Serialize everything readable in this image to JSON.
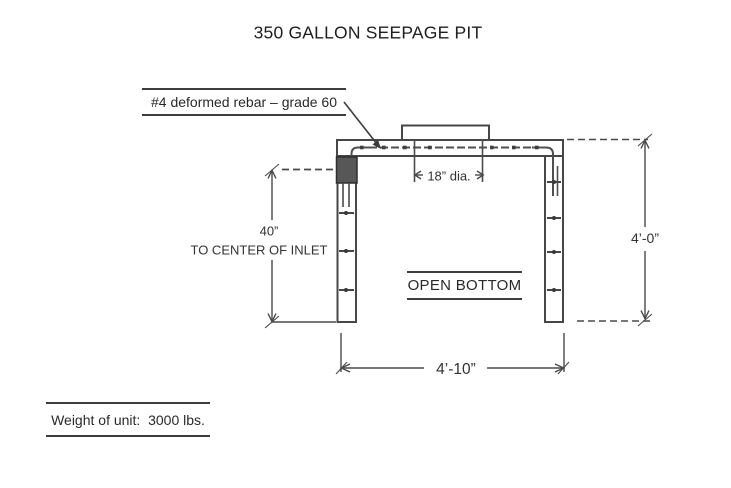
{
  "title": "350 GALLON SEEPAGE PIT",
  "annotations": {
    "rebar_note": "#4 deformed rebar – grade 60",
    "weight_note": "Weight of unit:  3000 lbs."
  },
  "dimensions": {
    "opening_diameter": "18” dia.",
    "inlet_height_value": "40”",
    "inlet_height_caption": "TO CENTER OF INLET",
    "overall_height": "4’-0”",
    "overall_width": "4’-10”"
  },
  "drawing": {
    "open_bottom_label": "OPEN BOTTOM"
  },
  "colors": {
    "line": "#474747",
    "dim_line": "#4a4a4a",
    "text": "#2e2e2e",
    "inlet_fill": "#575757",
    "background": "#ffffff"
  }
}
